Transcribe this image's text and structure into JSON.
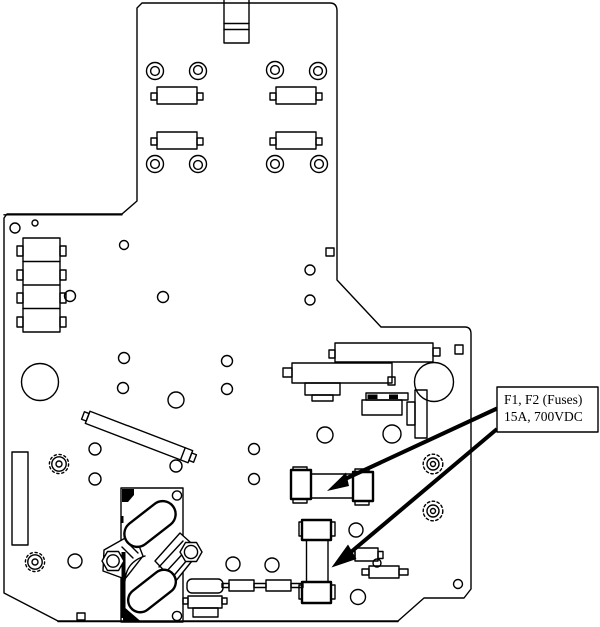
{
  "figure": {
    "callout": {
      "line1": "F1, F2 (Fuses)",
      "line2": "15A, 700VDC"
    },
    "colors": {
      "background": "#ffffff",
      "line": "#000000",
      "arrow": "#000000"
    }
  }
}
